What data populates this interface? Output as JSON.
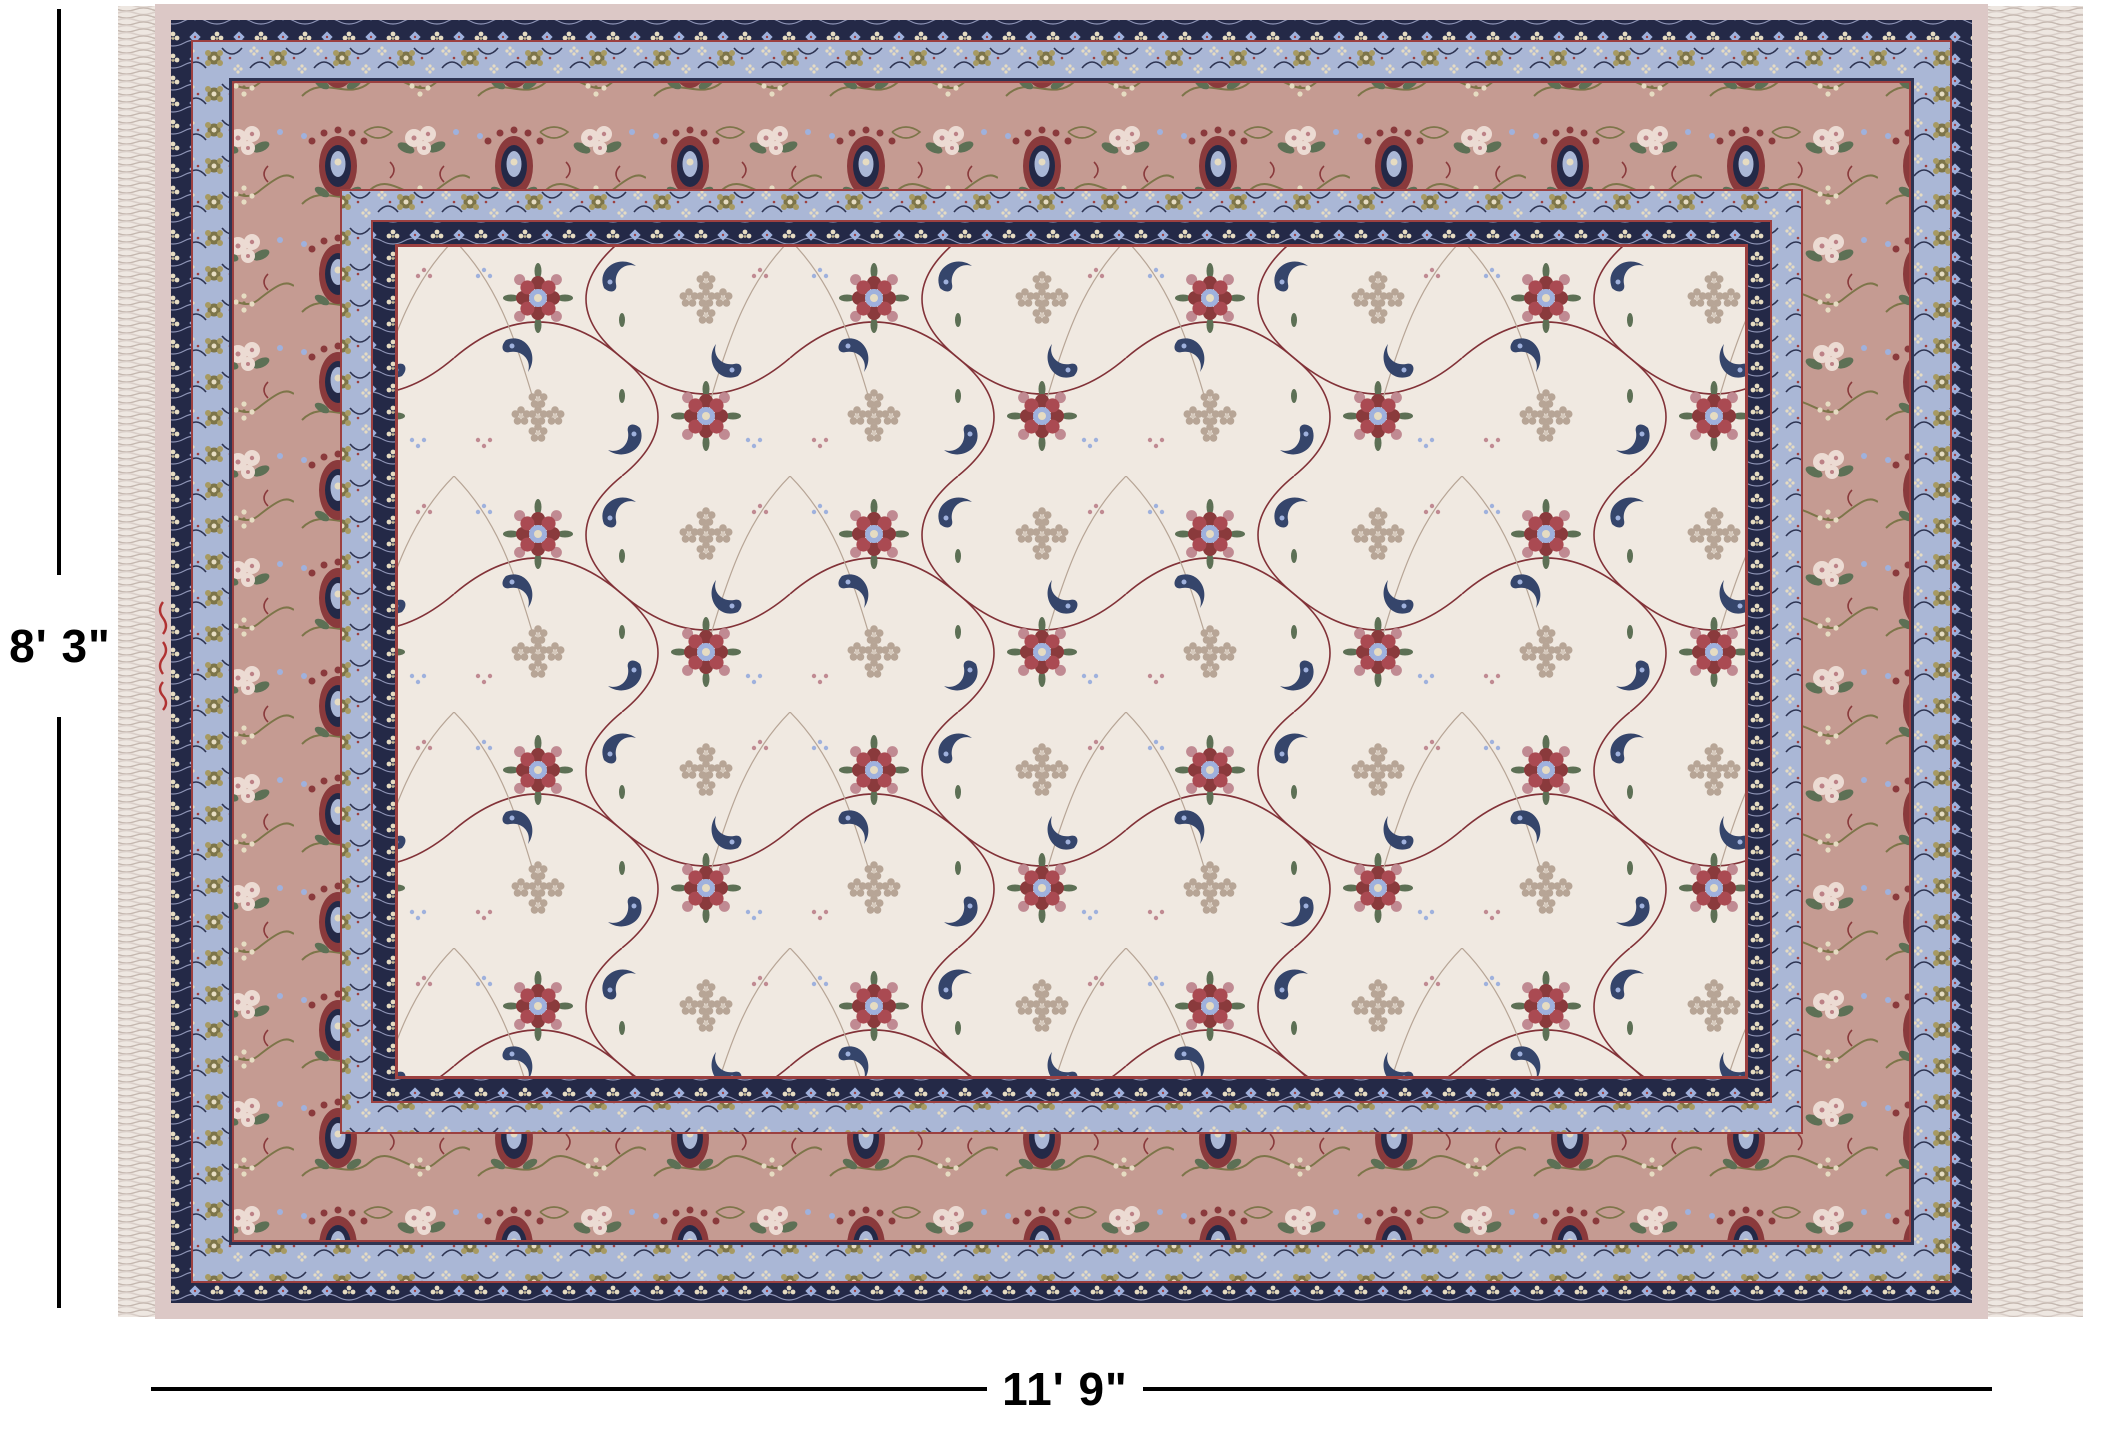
{
  "page": {
    "background": "#ffffff"
  },
  "annotation": {
    "height_label": "8' 3\"",
    "width_label": "11' 9\"",
    "line_color": "#000000"
  },
  "rug": {
    "description": "Ivory Isfahan-style Persian area rug with allover floral field, rose main border, periwinkle guard borders, navy bands and white side fringe",
    "palette": {
      "field_ivory": "#f0e9e1",
      "rose_border": "#c59b92",
      "periwinkle": "#aab7d6",
      "navy": "#242947",
      "navy_light": "#2e3452",
      "maroon": "#8a3a3c",
      "maroon_bright": "#aa4a52",
      "red_line": "#9c4040",
      "dusty_rose": "#c08a92",
      "blush": "#ecdbd3",
      "rose_center": "#bc8186",
      "sage": "#5d7055",
      "olive": "#7d7549",
      "olive_light": "#a79a62",
      "taupe": "#b7a596",
      "taupe_light": "#d6c9bc",
      "cream": "#e6dcc2",
      "cream_dark": "#c4b794",
      "blue_accent": "#9fb1dd",
      "crescent_navy": "#35456b",
      "selvage": "#dcc8c6",
      "fringe_base": "#eee7e1",
      "fringe_light": "#d9cec8",
      "fringe_dark": "#c4b7af",
      "signature": "#b03232",
      "vine": "#823238",
      "swag": "#8d93b5"
    }
  }
}
